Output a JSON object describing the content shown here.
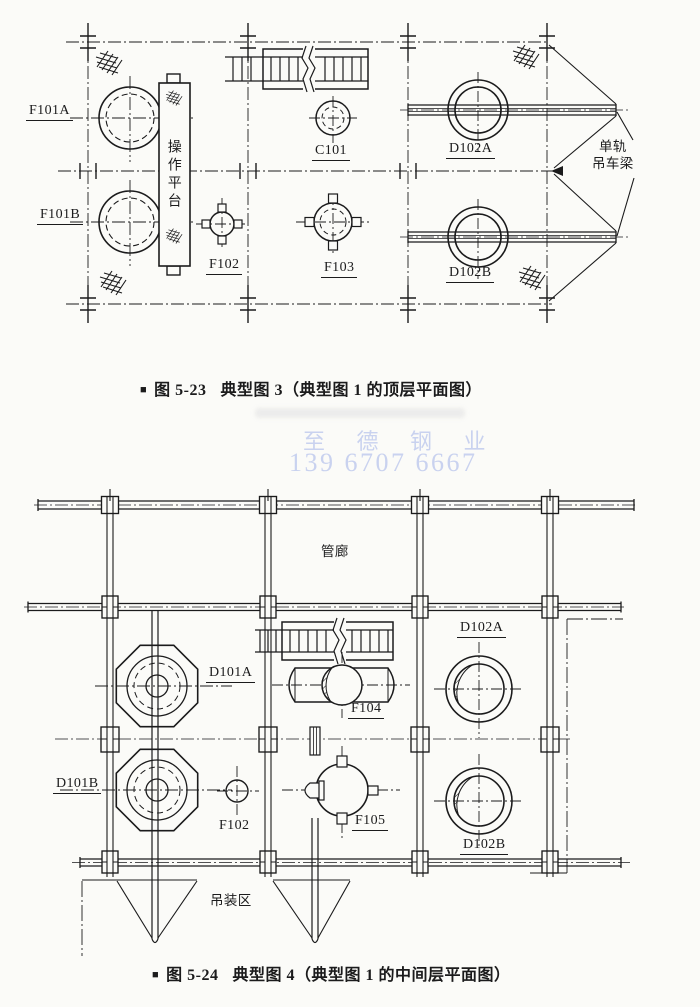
{
  "page": {
    "ink": "#1b1b1c",
    "paper": "#fbfbf8",
    "watermark_color": "#c9d2ef"
  },
  "watermark": {
    "line1": "至 德 钢 业",
    "line2": "139 6707 6667"
  },
  "figure_top": {
    "caption": {
      "marker": "■",
      "number": "图 5-23",
      "title": "典型图 3（典型图 1 的顶层平面图）"
    },
    "labels": {
      "f101a": "F101A",
      "f101b": "F101B",
      "platform": "操作平台",
      "c101": "C101",
      "f102": "F102",
      "f103": "F103",
      "d102a": "D102A",
      "d102b": "D102B",
      "monorail_line1": "单轨",
      "monorail_line2": "吊车梁"
    }
  },
  "figure_bottom": {
    "caption": {
      "marker": "■",
      "number": "图 5-24",
      "title": "典型图 4（典型图 1 的中间层平面图）"
    },
    "labels": {
      "pipe_gallery": "管廊",
      "d101a": "D101A",
      "d101b": "D101B",
      "f102": "F102",
      "f104": "F104",
      "f105": "F105",
      "d102a": "D102A",
      "d102b": "D102B",
      "lifting_area": "吊装区"
    }
  }
}
